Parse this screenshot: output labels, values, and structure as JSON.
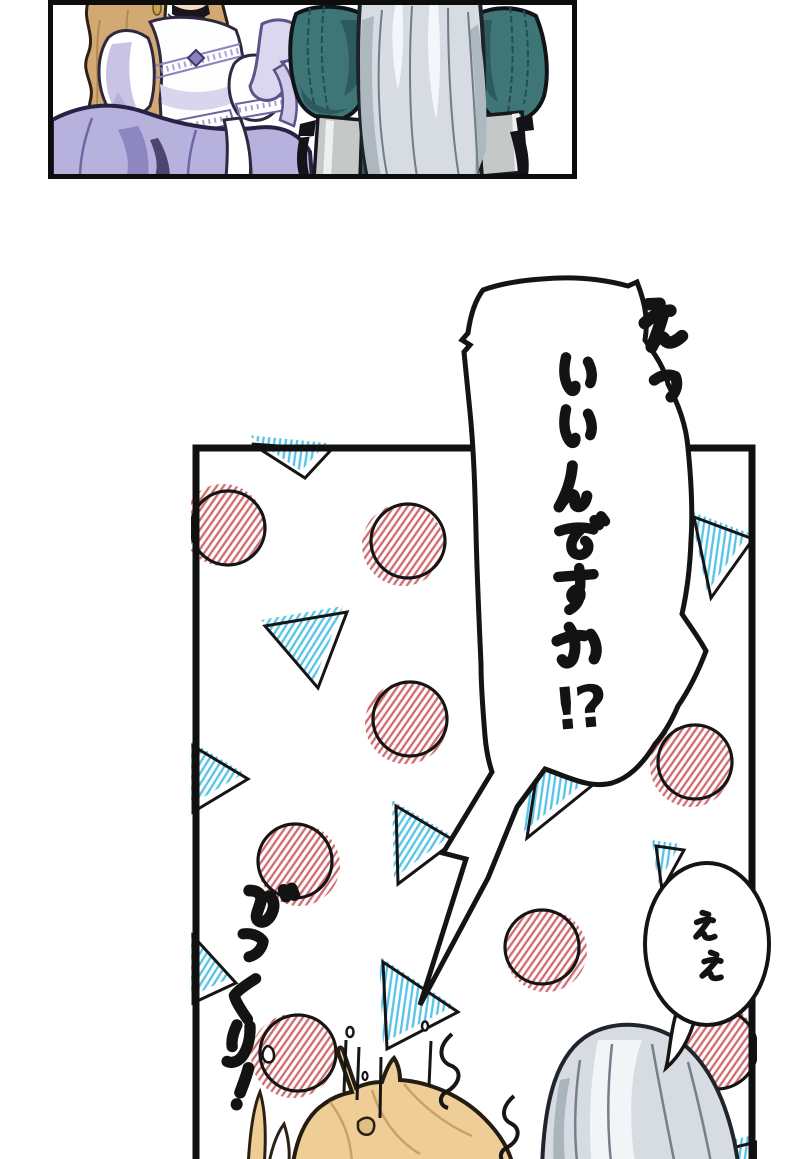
{
  "page": {
    "background": "#ffffff"
  },
  "bubbles": {
    "main": {
      "shout": "えっ",
      "text": "いいんですか!?",
      "tail_chars": "!?"
    },
    "reply": {
      "text": "ええ"
    }
  },
  "sfx": {
    "text": "びっくり!"
  },
  "colors": {
    "ink": "#141414",
    "hatch_red": "#d06a6e",
    "hatch_cyan": "#55c3e6",
    "lavender": "#b7b1dd",
    "lavender_deep": "#8d86c0",
    "teal": "#3e7577",
    "teal_deep": "#2c5a5e",
    "blonde": "#d2a972",
    "blonde_light": "#eecd96",
    "silver": "#d6dce1",
    "skin": "#f7dcc6"
  }
}
